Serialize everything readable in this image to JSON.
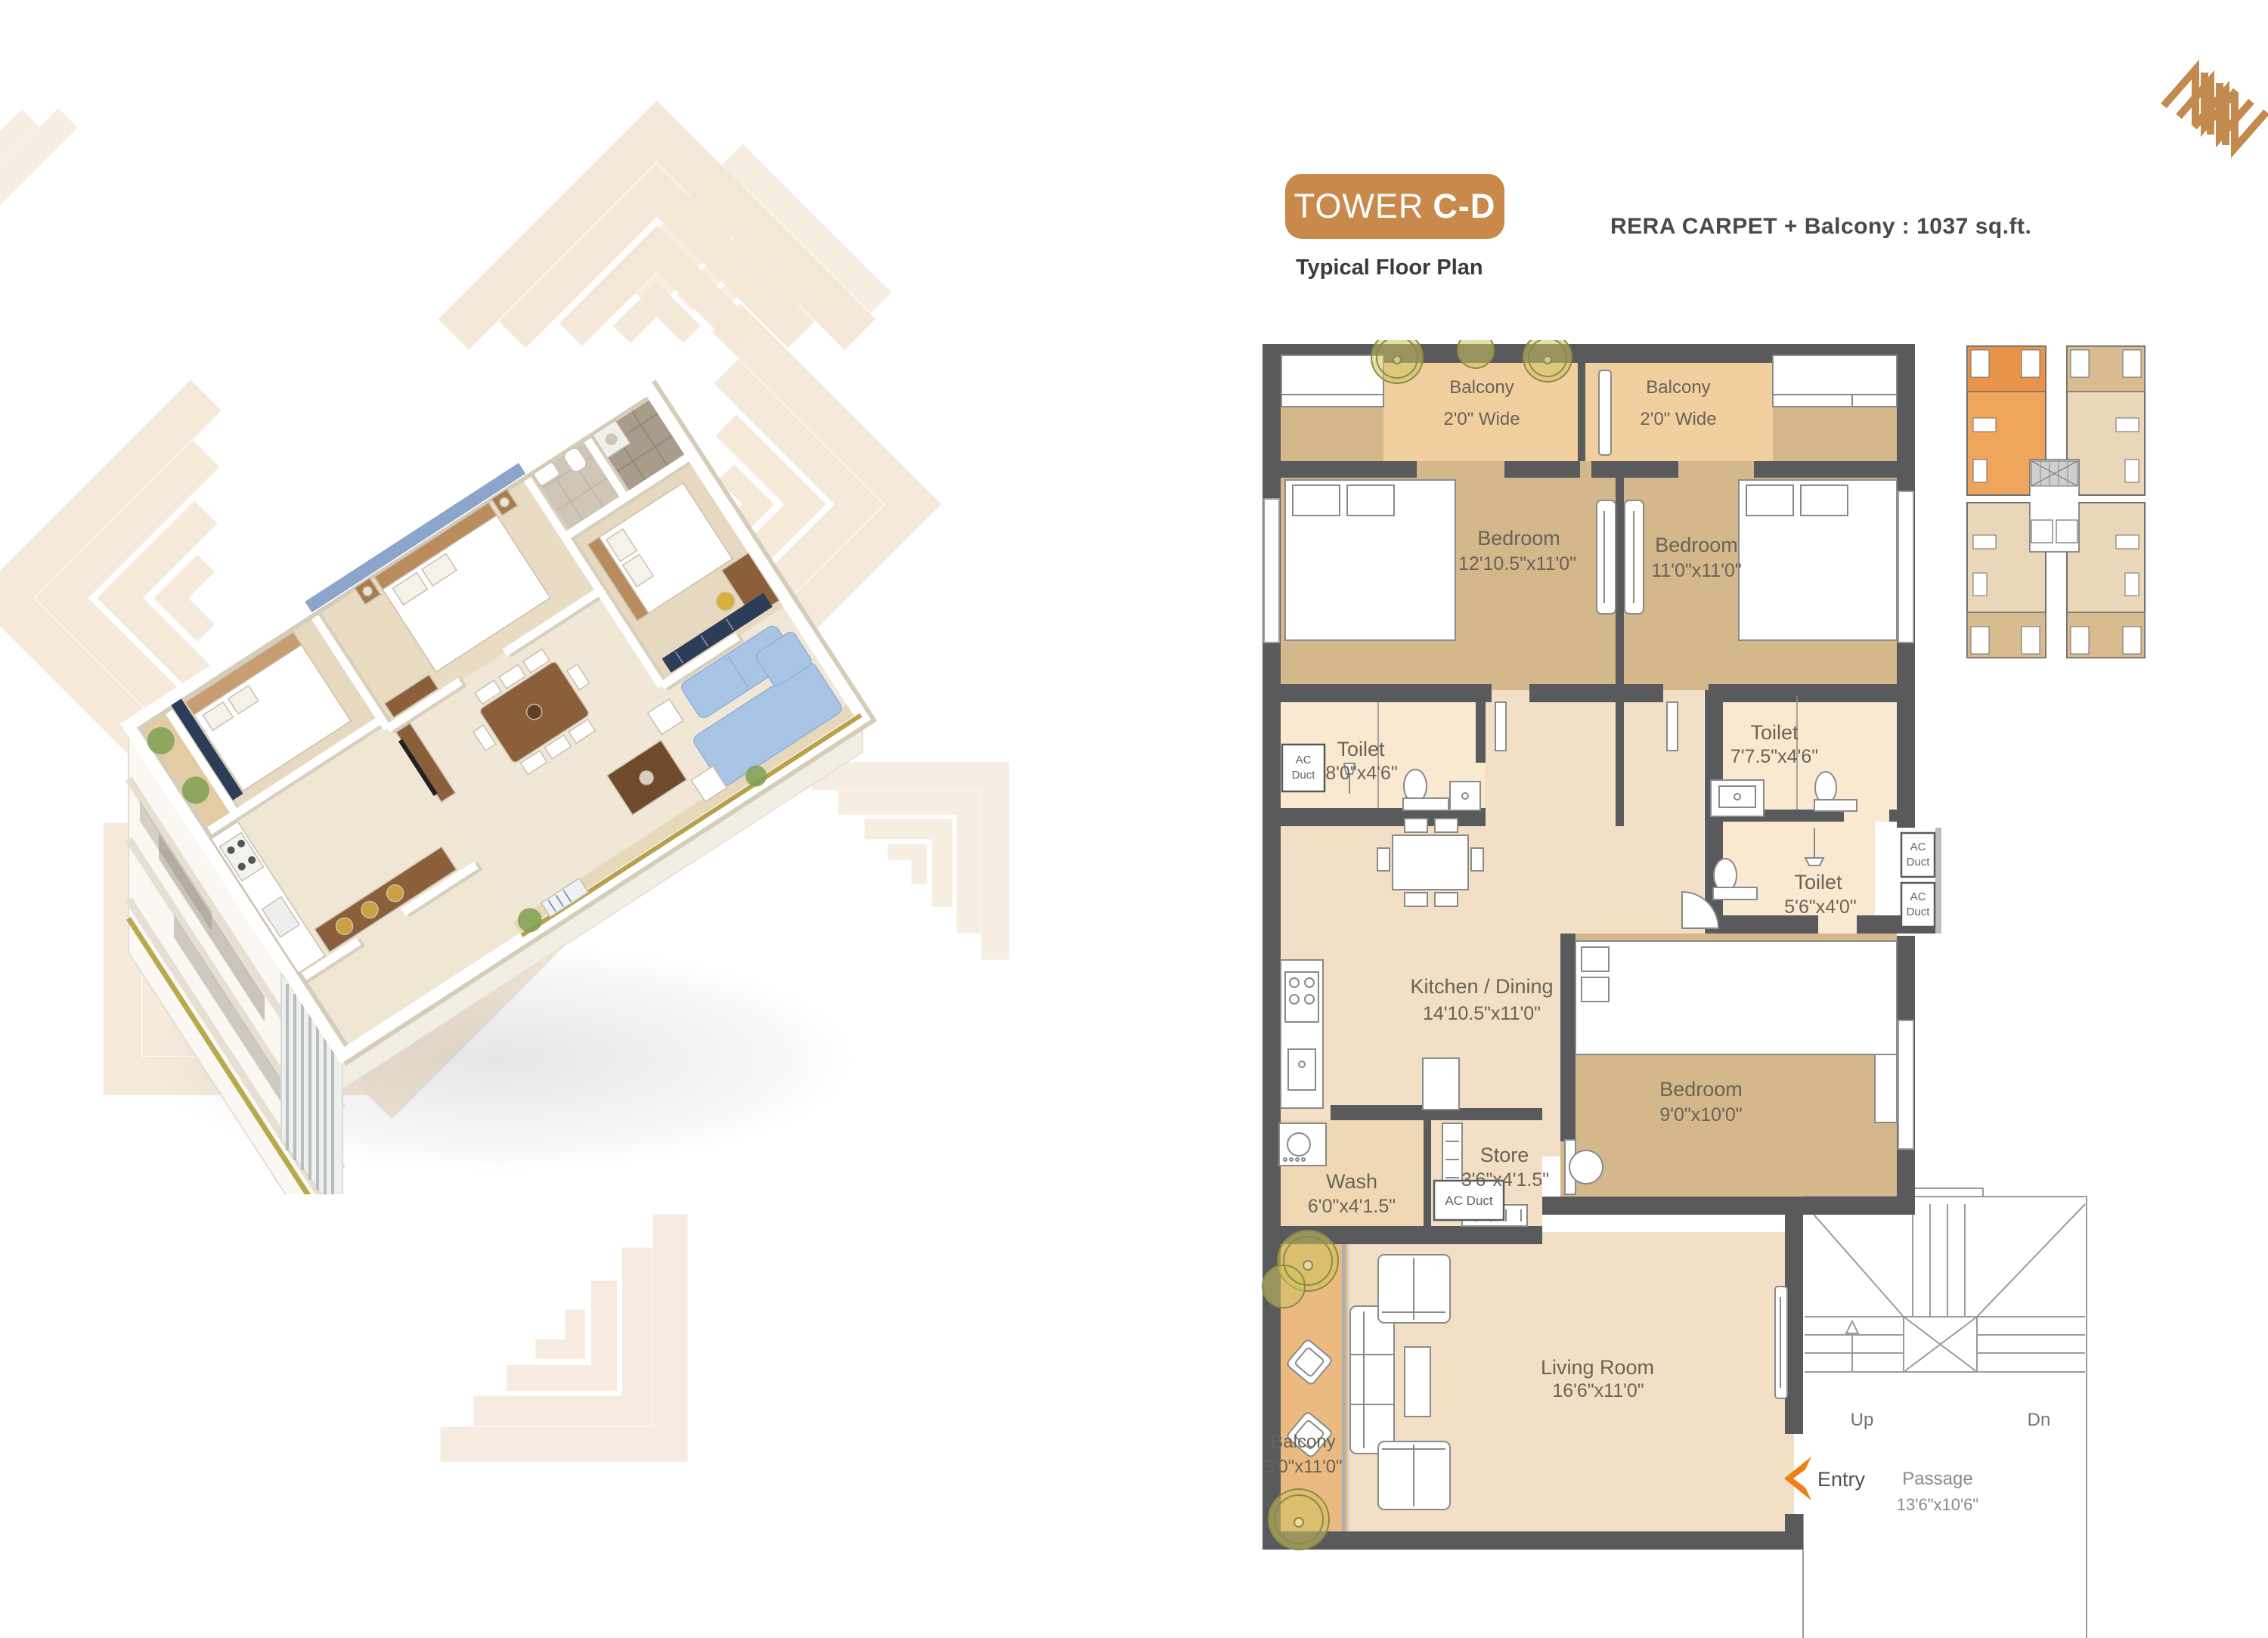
{
  "header": {
    "title_light": "TOWER",
    "title_bold": "C-D",
    "subtitle": "Typical Floor Plan",
    "area_note": "RERA CARPET + Balcony : 1037 sq.ft."
  },
  "plan": {
    "rooms": {
      "balcony_tl": {
        "name": "Balcony",
        "dims": "2'0\" Wide"
      },
      "balcony_tr": {
        "name": "Balcony",
        "dims": "2'0\" Wide"
      },
      "bedroom1": {
        "name": "Bedroom",
        "dims": "12'10.5\"x11'0\""
      },
      "bedroom2": {
        "name": "Bedroom",
        "dims": "11'0\"x11'0\""
      },
      "toilet1": {
        "name": "Toilet",
        "dims": "8'0\"x4'6\""
      },
      "toilet2": {
        "name": "Toilet",
        "dims": "7'7.5\"x4'6\""
      },
      "toilet3": {
        "name": "Toilet",
        "dims": "5'6\"x4'0\""
      },
      "kitchen": {
        "name": "Kitchen / Dining",
        "dims": "14'10.5\"x11'0\""
      },
      "bedroom3": {
        "name": "Bedroom",
        "dims": "9'0\"x10'0\""
      },
      "wash": {
        "name": "Wash",
        "dims": "6'0\"x4'1.5\""
      },
      "store": {
        "name": "Store",
        "dims": "3'6\"x4'1.5\""
      },
      "living": {
        "name": "Living Room",
        "dims": "16'6\"x11'0\""
      },
      "balcony_b": {
        "name": "Balcony",
        "dims": "3'0\"x11'0\""
      },
      "passage": {
        "name": "Passage",
        "dims": "13'6\"x10'6\""
      }
    },
    "labels": {
      "ac": "AC",
      "duct": "Duct",
      "ac_duct": "AC Duct",
      "entry": "Entry",
      "up": "Up",
      "dn": "Dn"
    }
  },
  "colors": {
    "accent": "#c9894a",
    "wall": "#595a5c",
    "entry_arrow": "#f07f13",
    "bedroom_floor": "#d5b78c",
    "living_floor": "#f2dfc5",
    "toilet_floor": "#f9e9d1",
    "balcony_floor": "#eaba80",
    "balcony_top_floor": "#f2cf9f",
    "keyplan_highlight": "#f0a55c",
    "pattern": "#f4e7d6",
    "accent_wall_blue": "#8ba5cb"
  }
}
